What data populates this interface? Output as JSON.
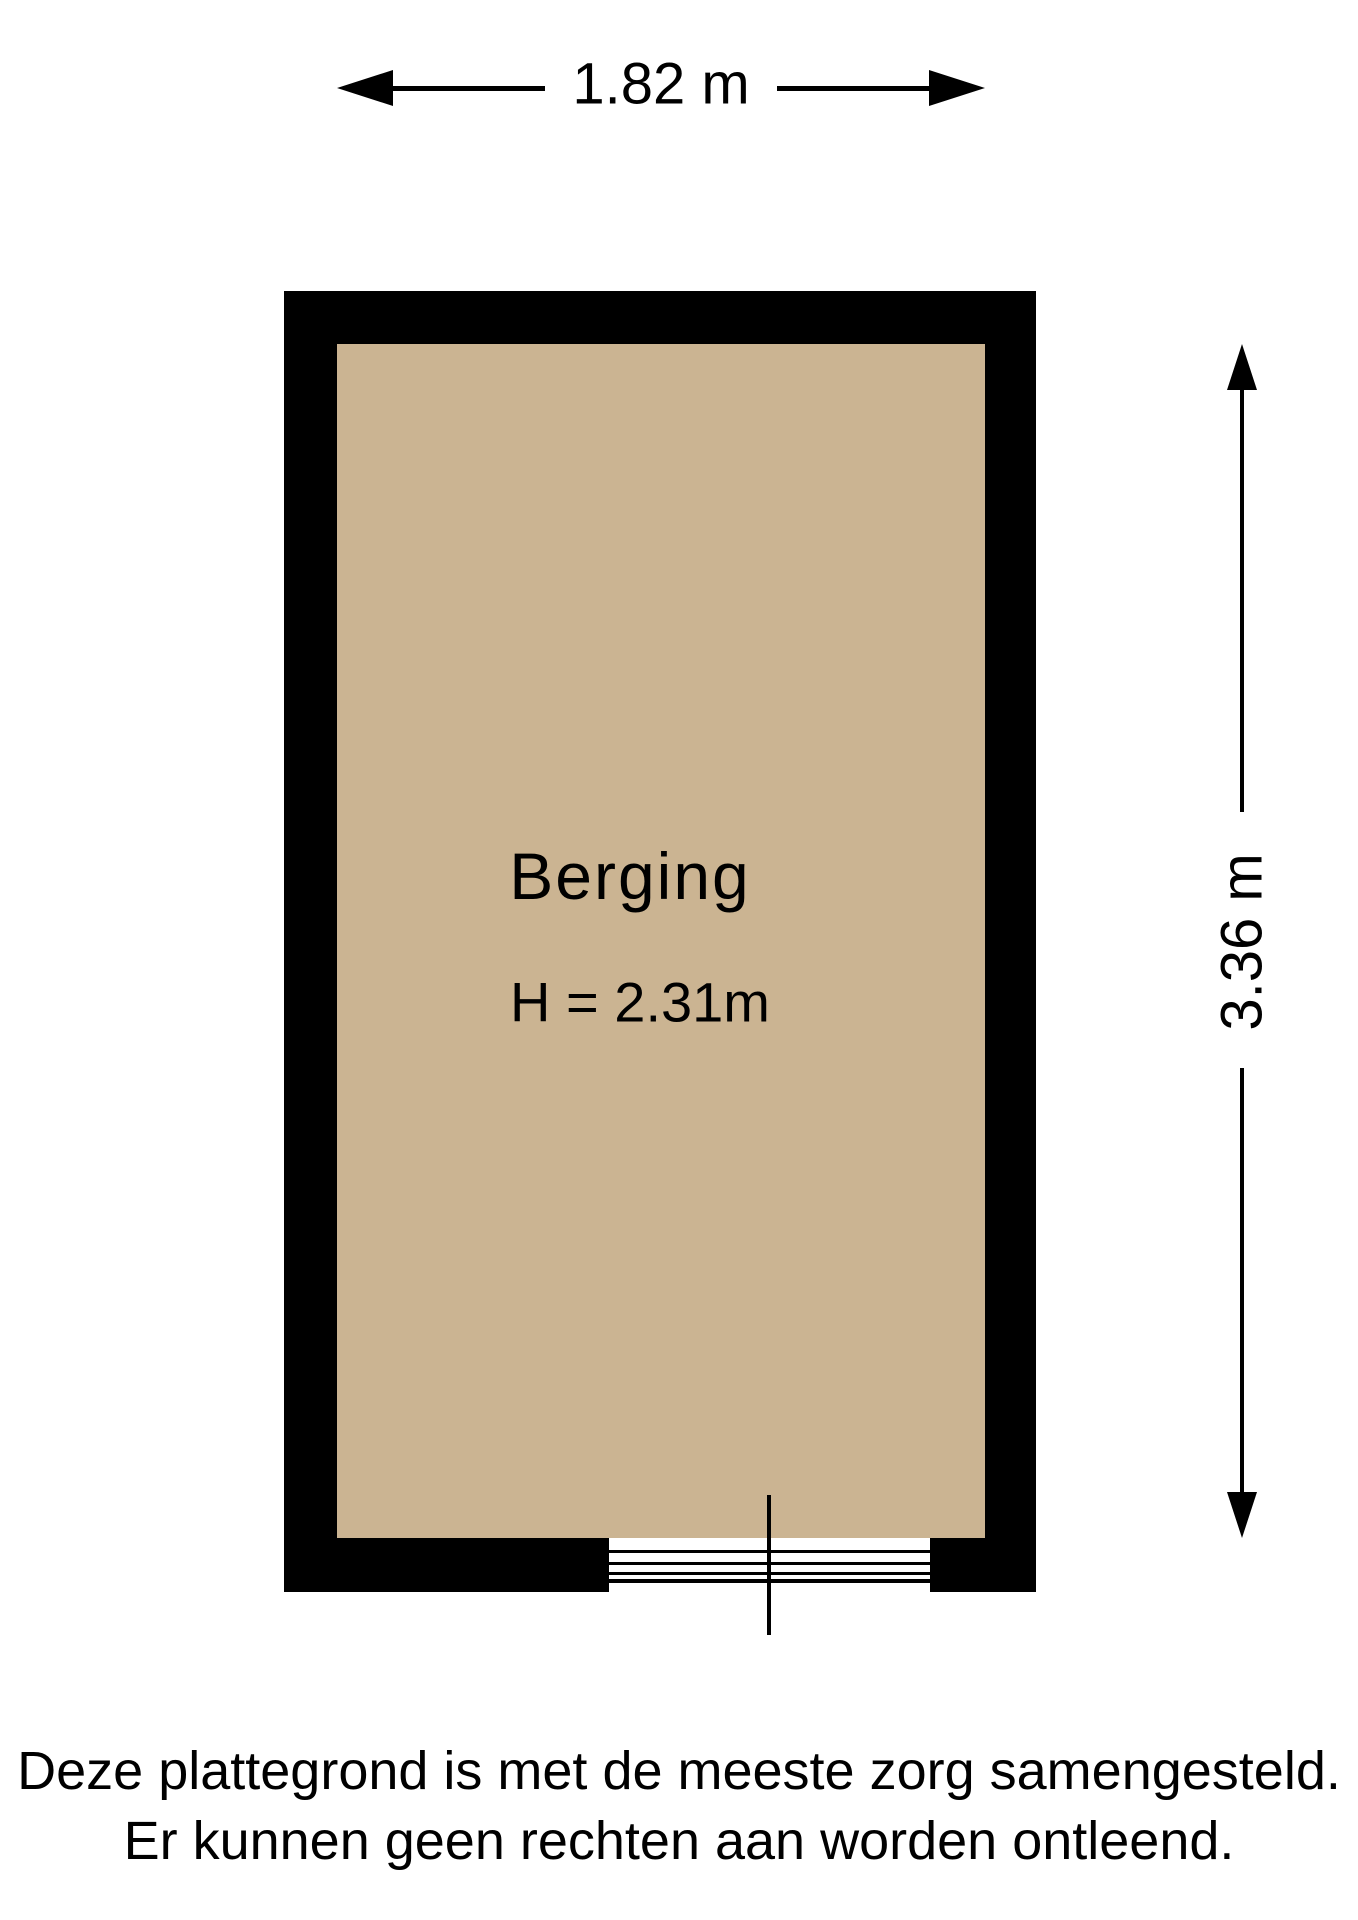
{
  "dimension_width": {
    "label": "1.82 m"
  },
  "dimension_height": {
    "label": "3.36 m"
  },
  "room": {
    "name": "Berging",
    "ceiling_height": "H = 2.31m"
  },
  "disclaimer": {
    "line1": "Deze plattegrond is met de meeste zorg samengesteld.",
    "line2": "Er kunnen geen rechten aan worden ontleend."
  },
  "colors": {
    "wall": "#000000",
    "floor": "#CBB492",
    "background": "#FFFFFF",
    "text": "#000000"
  }
}
